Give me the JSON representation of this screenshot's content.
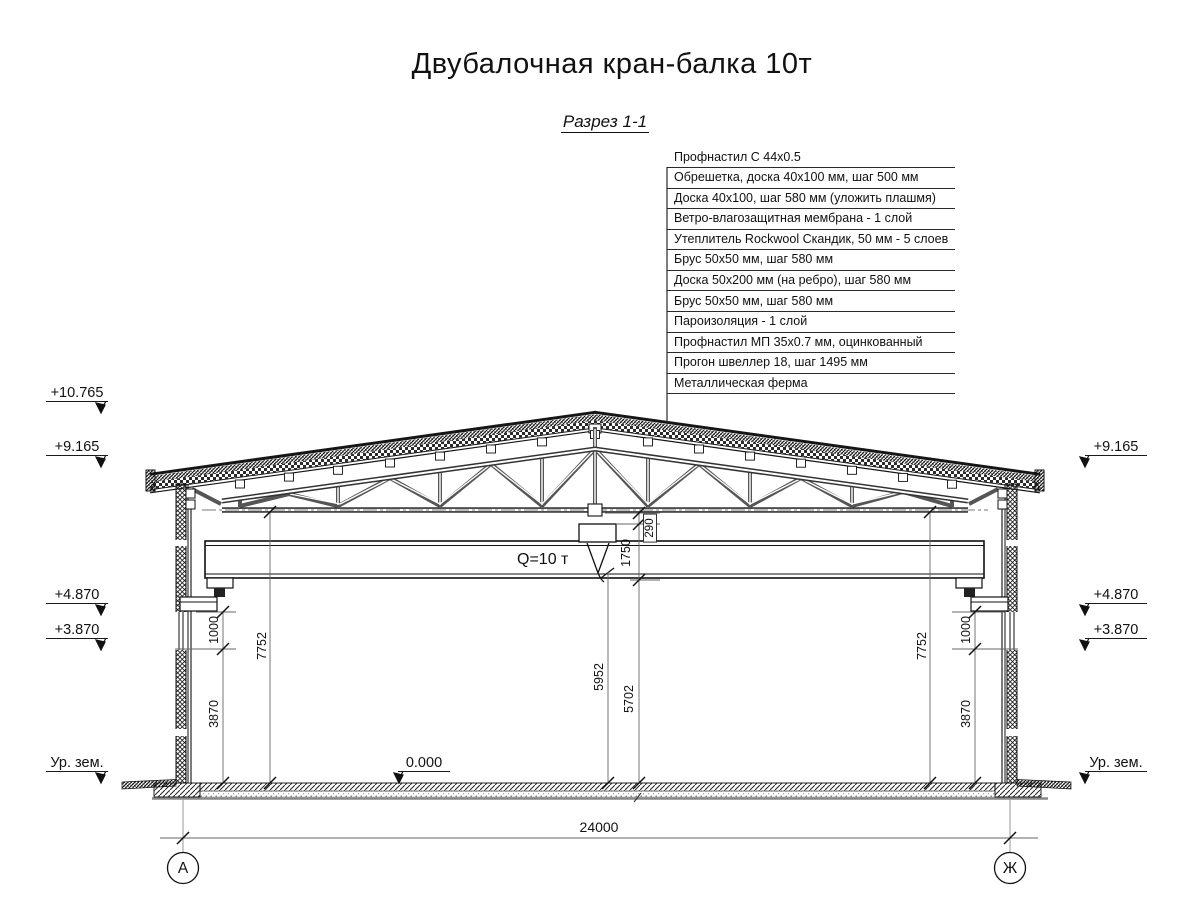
{
  "title": "Двубалочная кран-балка 10т",
  "section": {
    "label": "Разрез 1-1"
  },
  "callout_table": {
    "rows": [
      "Профнастил С 44х0.5",
      "Обрешетка, доска 40х100 мм, шаг 500 мм",
      "Доска 40х100, шаг 580 мм (уложить плашмя)",
      "Ветро-влагозащитная мембрана - 1 слой",
      "Утеплитель Rockwool Скандик, 50 мм - 5 слоев",
      "Брус 50х50 мм, шаг 580 мм",
      "Доска 50х200 мм (на ребро), шаг 580 мм",
      "Брус 50х50 мм, шаг 580 мм",
      "Пароизоляция - 1 слой",
      "Профнастил МП 35х0.7 мм, оцинкованный",
      "Прогон швеллер 18, шаг 1495 мм",
      "Металлическая ферма"
    ]
  },
  "elevations": {
    "ridge": "+10.765",
    "eaves_left": "+9.165",
    "eaves_right": "+9.165",
    "crane_rail_left": "+4.870",
    "crane_rail_right": "+4.870",
    "wall_joint_left": "+3.870",
    "wall_joint_right": "+3.870",
    "ground_left": "Ур. зем.",
    "ground_right": "Ур. зем.",
    "floor_zero": "0.000"
  },
  "dimensions": {
    "span": "24000",
    "truss_to_floor_left": "7752",
    "truss_to_floor_right": "7752",
    "console_left": "1000",
    "console_right": "1000",
    "wall_lower_left": "3870",
    "wall_lower_right": "3870",
    "chord_to_trolley": "290",
    "trolley_to_girder": "1750",
    "hook_to_floor": "5952",
    "hook_min_to_floor": "5702"
  },
  "crane": {
    "load_label": "Q=10 т"
  },
  "grid_axes": {
    "left": "А",
    "right": "Ж"
  }
}
